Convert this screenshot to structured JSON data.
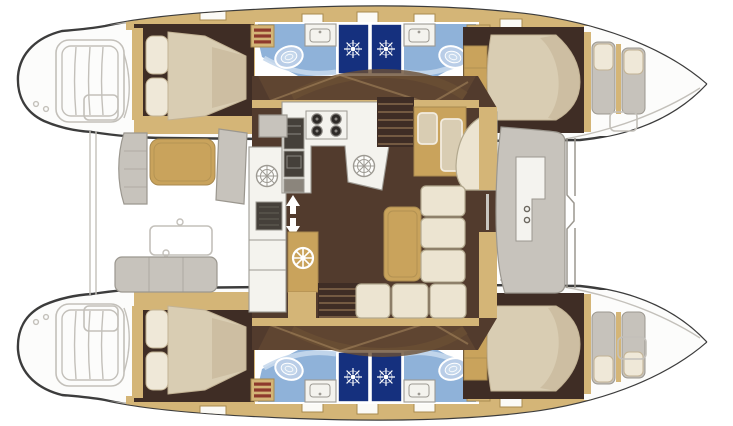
{
  "image": {
    "kind": "floor-plan",
    "subject": "Catamaran yacht interior layout plan, top-down view: four cabins with en-suite bathrooms in two hulls, central salon with galley and dinette, aft cockpit, forepeak crew berths",
    "rendered_text": []
  },
  "colors": {
    "paper": "#ffffff",
    "outline": "#3c3c3c",
    "hull-white": "#fcfcfb",
    "ext-line": "#c3c0ba",
    "ext-line-dark": "#9b978f",
    "ext-gray": "#c7c3bc",
    "deck-tan": "#d4b577",
    "deck-tan-dark": "#a98a4f",
    "tan-furniture": "#c9a35c",
    "cabin-floor": "#3f2d25",
    "salon-floor": "#523b2d",
    "salon-floor-light": "#6a4f35",
    "wood-line": "#a8895f",
    "bed": "#d9cdb3",
    "bed-shadow": "#c2b294",
    "pillow": "#efe8d8",
    "cushion": "#ece4d1",
    "cushion-line": "#b3a98f",
    "counter": "#f4f3ee",
    "counter-line": "#9d9a93",
    "appliance": "#45403a",
    "bath-floor": "#8fb2d9",
    "bath-floor-light": "#c6d8ec",
    "shower": "#2b55b4",
    "shower-dark": "#15307e",
    "toilet": "#b9cde7",
    "red-stripe": "#8e3a2c",
    "berth-gray": "#c6c2bb"
  }
}
